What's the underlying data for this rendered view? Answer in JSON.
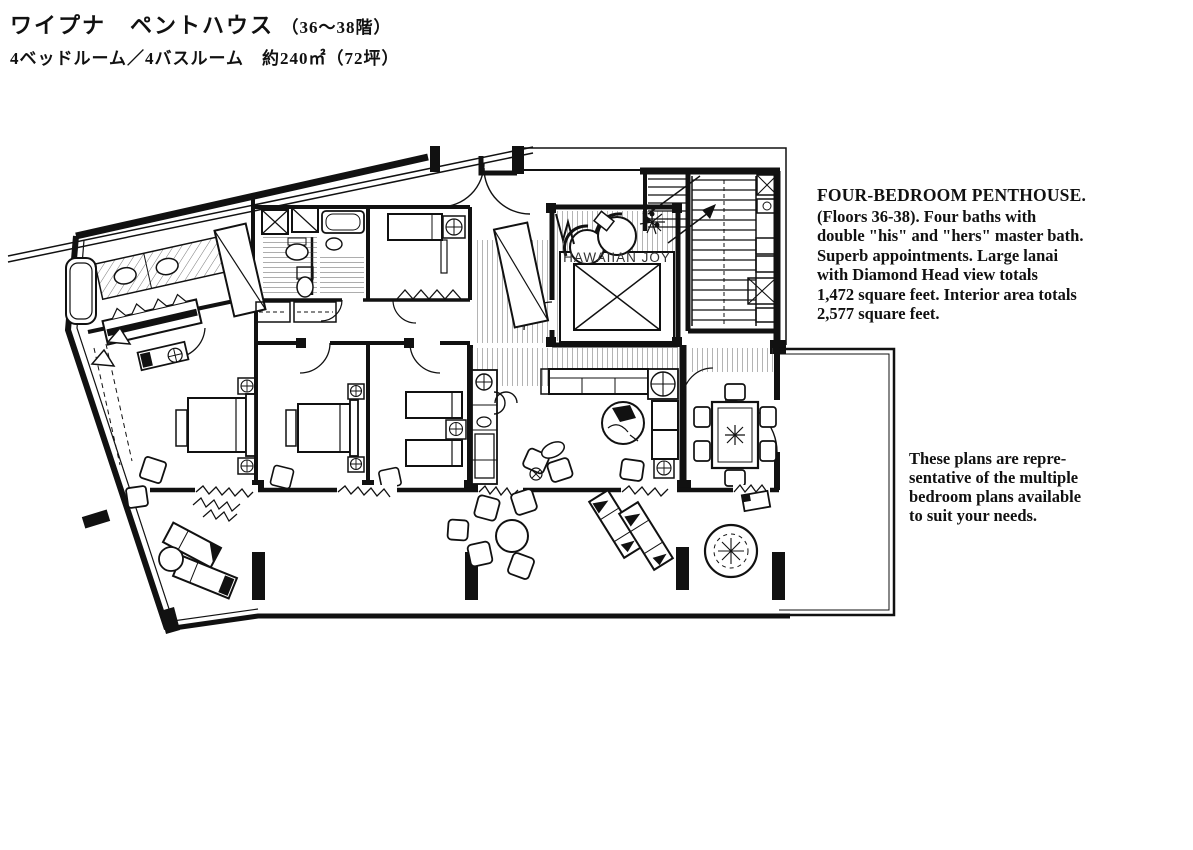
{
  "header": {
    "title": "ワイプナ　ペントハウス",
    "floors_suffix": "（36〜38階）",
    "subtitle": "4ベッドルーム／4バスルーム　約240㎡（72坪）"
  },
  "description": {
    "heading": "FOUR-BEDROOM PENTHOUSE.",
    "body": "(Floors 36-38). Four baths with\ndouble \"his\" and \"hers\" master bath.\nSuperb appointments. Large lanai\nwith Diamond Head view totals\n1,472 square feet. Interior area totals\n2,577 square feet."
  },
  "note": {
    "text": "These plans are repre-\nsentative of the multiple\nbedroom plans available\nto suit your needs."
  },
  "floor_plan": {
    "spa_label": "HAWAIIAN JOY",
    "ink_color": "#111111",
    "paper_color": "#ffffff"
  }
}
